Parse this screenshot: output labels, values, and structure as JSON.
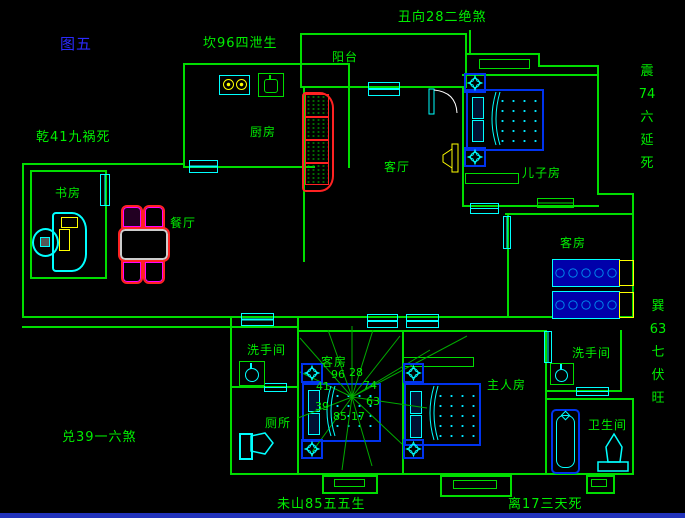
{
  "figure": {
    "label": "图五"
  },
  "annotations": {
    "top_center": "坎96四泄生",
    "top_right": "丑向28二绝煞",
    "left_upper": "乾41九祸死",
    "left_lower": "兑39一六煞",
    "right_upper_vertical": "震\n74\n六\n延\n死",
    "right_lower_vertical": "巽\n63\n七\n伏\n旺",
    "bottom_left": "未山85五五生",
    "bottom_right": "离17三天死"
  },
  "rooms": {
    "kitchen": "厨房",
    "balcony": "阳台",
    "living": "客厅",
    "son": "儿子房",
    "guest_right": "客房",
    "study": "书房",
    "dining": "餐厅",
    "washroom_left": "洗手间",
    "toilet": "厕所",
    "guest_center": "客房",
    "master": "主人房",
    "washroom_right": "洗手间",
    "bathroom": "卫生间"
  },
  "compass": {
    "values": [
      "96",
      "28",
      "41",
      "74",
      "39",
      "63",
      "85",
      "17"
    ]
  },
  "colors": {
    "wall_green": "#00dd00",
    "text_green": "#00ee00",
    "figure_blue": "#2a2aff",
    "cad_cyan": "#00ffff",
    "cad_blue": "#0033ee",
    "cad_yellow": "#ffff00",
    "cad_red": "#ff2222",
    "cad_magenta": "#ff00ff",
    "statusbar_blue": "#2233bb"
  }
}
